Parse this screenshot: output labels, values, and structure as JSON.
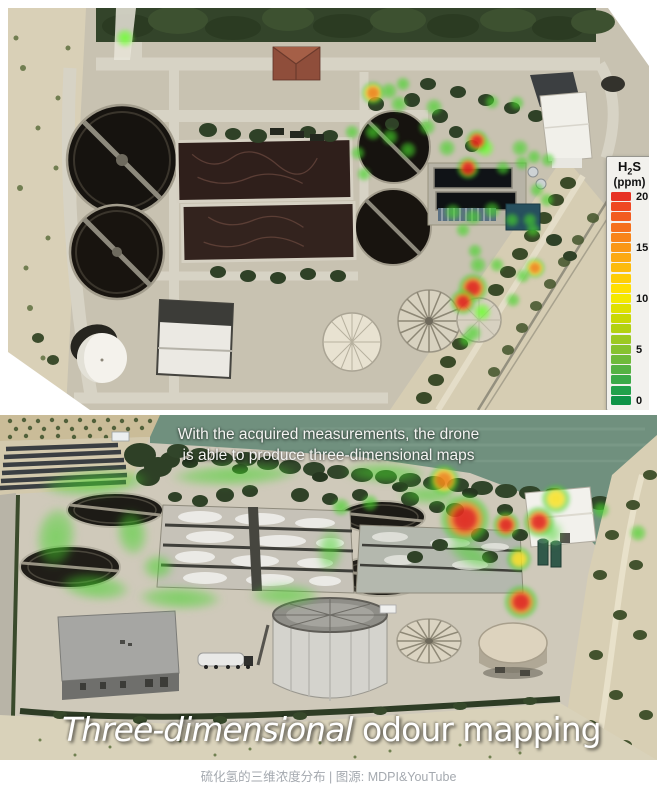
{
  "figure_top": {
    "legend": {
      "title_parts": [
        "H",
        "2",
        "S"
      ],
      "unit": "(ppm)",
      "tick_labels": [
        "20",
        "15",
        "10",
        "5",
        "0"
      ],
      "swatches": [
        "#e73223",
        "#ef4722",
        "#f25c20",
        "#f5701d",
        "#f8841a",
        "#fa9716",
        "#fca912",
        "#fdbb0d",
        "#fecd07",
        "#ffdf02",
        "#f4e800",
        "#dfe000",
        "#c9d804",
        "#b3d111",
        "#9cc922",
        "#86c22f",
        "#6eba3a",
        "#55b243",
        "#3baa48",
        "#21a14a",
        "#0f9447"
      ]
    },
    "spots": [
      {
        "x": 117,
        "y": 30,
        "r": 9,
        "t": "bright"
      },
      {
        "x": 365,
        "y": 85,
        "r": 10,
        "t": "orange"
      },
      {
        "x": 381,
        "y": 83,
        "r": 8,
        "t": "green"
      },
      {
        "x": 395,
        "y": 76,
        "r": 7,
        "t": "green"
      },
      {
        "x": 391,
        "y": 96,
        "r": 8,
        "t": "green"
      },
      {
        "x": 426,
        "y": 99,
        "r": 8,
        "t": "green"
      },
      {
        "x": 419,
        "y": 119,
        "r": 8,
        "t": "green"
      },
      {
        "x": 439,
        "y": 140,
        "r": 8,
        "t": "green"
      },
      {
        "x": 484,
        "y": 94,
        "r": 7,
        "t": "green"
      },
      {
        "x": 509,
        "y": 95,
        "r": 7,
        "t": "green"
      },
      {
        "x": 512,
        "y": 140,
        "r": 8,
        "t": "green"
      },
      {
        "x": 477,
        "y": 140,
        "r": 9,
        "t": "bright"
      },
      {
        "x": 469,
        "y": 133,
        "r": 10,
        "t": "red"
      },
      {
        "x": 460,
        "y": 160,
        "r": 10,
        "t": "red"
      },
      {
        "x": 495,
        "y": 160,
        "r": 7,
        "t": "green"
      },
      {
        "x": 514,
        "y": 155,
        "r": 7,
        "t": "green"
      },
      {
        "x": 526,
        "y": 149,
        "r": 7,
        "t": "green"
      },
      {
        "x": 540,
        "y": 152,
        "r": 7,
        "t": "green"
      },
      {
        "x": 529,
        "y": 182,
        "r": 7,
        "t": "green"
      },
      {
        "x": 539,
        "y": 192,
        "r": 7,
        "t": "green"
      },
      {
        "x": 522,
        "y": 212,
        "r": 7,
        "t": "green"
      },
      {
        "x": 365,
        "y": 124,
        "r": 8,
        "t": "green"
      },
      {
        "x": 382,
        "y": 129,
        "r": 8,
        "t": "green"
      },
      {
        "x": 400,
        "y": 142,
        "r": 8,
        "t": "green"
      },
      {
        "x": 344,
        "y": 124,
        "r": 7,
        "t": "green"
      },
      {
        "x": 350,
        "y": 145,
        "r": 7,
        "t": "green"
      },
      {
        "x": 356,
        "y": 166,
        "r": 7,
        "t": "green"
      },
      {
        "x": 445,
        "y": 204,
        "r": 8,
        "t": "green"
      },
      {
        "x": 455,
        "y": 222,
        "r": 7,
        "t": "green"
      },
      {
        "x": 465,
        "y": 209,
        "r": 8,
        "t": "green"
      },
      {
        "x": 484,
        "y": 202,
        "r": 8,
        "t": "green"
      },
      {
        "x": 504,
        "y": 212,
        "r": 7,
        "t": "green"
      },
      {
        "x": 525,
        "y": 222,
        "r": 7,
        "t": "green"
      },
      {
        "x": 470,
        "y": 257,
        "r": 8,
        "t": "green"
      },
      {
        "x": 489,
        "y": 257,
        "r": 7,
        "t": "green"
      },
      {
        "x": 467,
        "y": 243,
        "r": 7,
        "t": "green"
      },
      {
        "x": 474,
        "y": 304,
        "r": 9,
        "t": "bright"
      },
      {
        "x": 465,
        "y": 280,
        "r": 13,
        "t": "red"
      },
      {
        "x": 455,
        "y": 294,
        "r": 11,
        "t": "red"
      },
      {
        "x": 527,
        "y": 260,
        "r": 9,
        "t": "orange"
      },
      {
        "x": 515,
        "y": 268,
        "r": 7,
        "t": "green"
      },
      {
        "x": 465,
        "y": 325,
        "r": 8,
        "t": "green"
      },
      {
        "x": 458,
        "y": 332,
        "r": 7,
        "t": "green"
      },
      {
        "x": 505,
        "y": 292,
        "r": 7,
        "t": "green"
      }
    ]
  },
  "figure_bottom": {
    "subtitle_line1": "With the acquired measurements, the drone",
    "subtitle_line2": "is able to produce three-dimensional maps",
    "title_italic": "Three-dimensional",
    "title_regular": " odour mapping",
    "ribbons": [
      {
        "x": 95,
        "y": 68,
        "rx": 72,
        "ry": 17,
        "rot": -4
      },
      {
        "x": 235,
        "y": 60,
        "rx": 85,
        "ry": 14,
        "rot": -2
      },
      {
        "x": 385,
        "y": 58,
        "rx": 55,
        "ry": 13,
        "rot": 2
      },
      {
        "x": 56,
        "y": 122,
        "rx": 26,
        "ry": 40,
        "rot": 8
      },
      {
        "x": 95,
        "y": 172,
        "rx": 46,
        "ry": 17,
        "rot": 6
      },
      {
        "x": 180,
        "y": 183,
        "rx": 55,
        "ry": 15,
        "rot": 2
      },
      {
        "x": 285,
        "y": 180,
        "rx": 46,
        "ry": 14,
        "rot": 0
      },
      {
        "x": 132,
        "y": 118,
        "rx": 20,
        "ry": 30,
        "rot": -8
      },
      {
        "x": 330,
        "y": 135,
        "rx": 16,
        "ry": 28,
        "rot": 4
      },
      {
        "x": 428,
        "y": 80,
        "rx": 40,
        "ry": 12,
        "rot": 3
      },
      {
        "x": 158,
        "y": 152,
        "rx": 20,
        "ry": 16,
        "rot": 0
      },
      {
        "x": 472,
        "y": 140,
        "rx": 35,
        "ry": 14,
        "rot": 25
      },
      {
        "x": 552,
        "y": 118,
        "rx": 13,
        "ry": 16,
        "rot": 0
      }
    ],
    "spots": [
      {
        "x": 444,
        "y": 65,
        "r": 13,
        "t": "orange"
      },
      {
        "x": 465,
        "y": 104,
        "r": 22,
        "t": "red"
      },
      {
        "x": 506,
        "y": 110,
        "r": 12,
        "t": "red"
      },
      {
        "x": 539,
        "y": 107,
        "r": 14,
        "t": "red"
      },
      {
        "x": 556,
        "y": 84,
        "r": 13,
        "t": "yellow"
      },
      {
        "x": 519,
        "y": 144,
        "r": 11,
        "t": "yellow"
      },
      {
        "x": 521,
        "y": 187,
        "r": 15,
        "t": "red"
      },
      {
        "x": 601,
        "y": 95,
        "r": 8,
        "t": "green"
      },
      {
        "x": 638,
        "y": 118,
        "r": 8,
        "t": "green"
      },
      {
        "x": 341,
        "y": 92,
        "r": 9,
        "t": "green"
      },
      {
        "x": 370,
        "y": 88,
        "r": 8,
        "t": "green"
      }
    ]
  },
  "spot_palette": {
    "green": "#46d42a",
    "bright": "#6eff32",
    "red": "#e12a1e",
    "orange": "#f0891a",
    "yellow": "#f7e122"
  },
  "caption": {
    "text": "硫化氢的三维浓度分布 | 图源: MDPI&YouTube"
  }
}
